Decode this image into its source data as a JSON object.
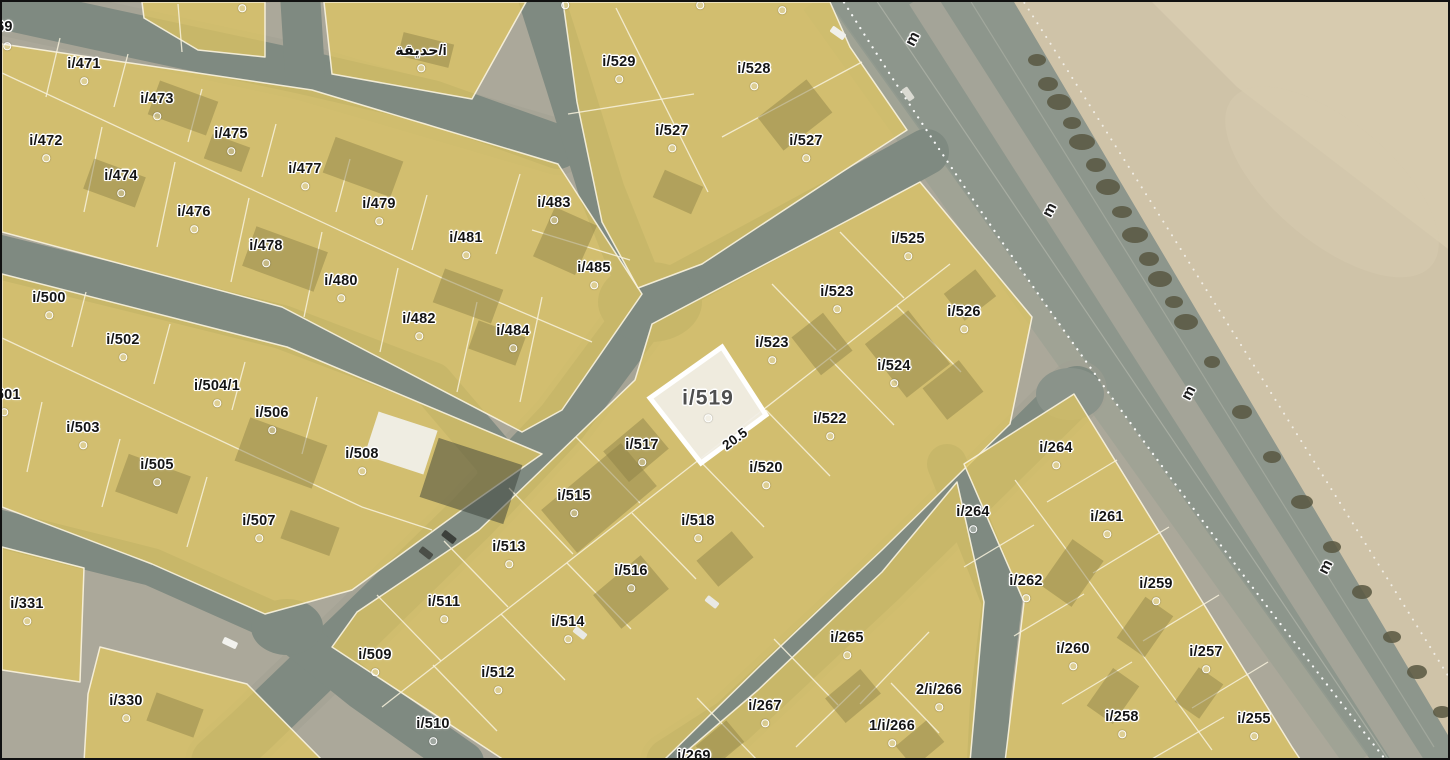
{
  "map": {
    "type": "cadastral-satellite-map",
    "selected_parcel": {
      "label": "i/519",
      "edge_dimension": "20.5"
    },
    "garden_label": "حديقة/i",
    "road_letter": "m",
    "colors": {
      "ground": "#aba89a",
      "parcel": "#dcc463",
      "parcel-line": "#f8f2dd",
      "selected-fill": "#f1eee6",
      "selected-border": "#ffffff",
      "selected-label": "#4f4f4f",
      "road": "#7f8a81",
      "arterial": "#8d968c",
      "sand": "#cfc3a8",
      "vegetation": "#585741",
      "label": "#141414"
    },
    "labels": [
      {
        "t": "i/469",
        "x": -6,
        "y": 25,
        "dot": false
      },
      {
        "t": "i/471",
        "x": 82,
        "y": 62
      },
      {
        "t": "i/473",
        "x": 155,
        "y": 97
      },
      {
        "t": "i/475",
        "x": 229,
        "y": 132
      },
      {
        "t": "i/477",
        "x": 303,
        "y": 167
      },
      {
        "t": "i/479",
        "x": 377,
        "y": 202
      },
      {
        "t": "i/481",
        "x": 464,
        "y": 236
      },
      {
        "t": "i/483",
        "x": 552,
        "y": 201
      },
      {
        "t": "i/485",
        "x": 592,
        "y": 266
      },
      {
        "t": "i/472",
        "x": 44,
        "y": 139
      },
      {
        "t": "i/474",
        "x": 119,
        "y": 174
      },
      {
        "t": "i/476",
        "x": 192,
        "y": 210
      },
      {
        "t": "i/478",
        "x": 264,
        "y": 244
      },
      {
        "t": "i/480",
        "x": 339,
        "y": 279
      },
      {
        "t": "i/482",
        "x": 417,
        "y": 317
      },
      {
        "t": "i/484",
        "x": 511,
        "y": 329
      },
      {
        "t": "حديقة/i",
        "x": 419,
        "y": 49
      },
      {
        "t": "i/529",
        "x": 617,
        "y": 60
      },
      {
        "t": "i/527",
        "x": 670,
        "y": 129
      },
      {
        "t": "i/528",
        "x": 752,
        "y": 67
      },
      {
        "t": "i/527",
        "x": 804,
        "y": 139
      },
      {
        "t": "i/500",
        "x": 47,
        "y": 296
      },
      {
        "t": "i/502",
        "x": 121,
        "y": 338
      },
      {
        "t": "i/504/1",
        "x": 215,
        "y": 384
      },
      {
        "t": "i/506",
        "x": 270,
        "y": 411
      },
      {
        "t": "i/508",
        "x": 360,
        "y": 452
      },
      {
        "t": "i/501",
        "x": 2,
        "y": 393
      },
      {
        "t": "i/503",
        "x": 81,
        "y": 426
      },
      {
        "t": "i/505",
        "x": 155,
        "y": 463
      },
      {
        "t": "i/507",
        "x": 257,
        "y": 519
      },
      {
        "t": "i/331",
        "x": 25,
        "y": 602
      },
      {
        "t": "i/330",
        "x": 124,
        "y": 699
      },
      {
        "t": "i/509",
        "x": 373,
        "y": 653
      },
      {
        "t": "i/511",
        "x": 442,
        "y": 600
      },
      {
        "t": "i/513",
        "x": 507,
        "y": 545
      },
      {
        "t": "i/515",
        "x": 572,
        "y": 494
      },
      {
        "t": "i/517",
        "x": 640,
        "y": 443
      },
      {
        "t": "i/519",
        "x": 706,
        "y": 396,
        "k": "big"
      },
      {
        "t": "20.5",
        "x": 733,
        "y": 437,
        "k": "dim",
        "dot": false
      },
      {
        "t": "i/510",
        "x": 431,
        "y": 722
      },
      {
        "t": "i/512",
        "x": 496,
        "y": 671
      },
      {
        "t": "i/514",
        "x": 566,
        "y": 620
      },
      {
        "t": "i/516",
        "x": 629,
        "y": 569
      },
      {
        "t": "i/518",
        "x": 696,
        "y": 519
      },
      {
        "t": "i/520",
        "x": 764,
        "y": 466
      },
      {
        "t": "i/522",
        "x": 828,
        "y": 417
      },
      {
        "t": "i/523",
        "x": 770,
        "y": 341
      },
      {
        "t": "i/523",
        "x": 835,
        "y": 290
      },
      {
        "t": "i/525",
        "x": 906,
        "y": 237
      },
      {
        "t": "i/526",
        "x": 962,
        "y": 310
      },
      {
        "t": "i/524",
        "x": 892,
        "y": 364
      },
      {
        "t": "i/265",
        "x": 845,
        "y": 636
      },
      {
        "t": "i/267",
        "x": 763,
        "y": 704
      },
      {
        "t": "i/269",
        "x": 692,
        "y": 754,
        "dot": false
      },
      {
        "t": "1/i/266",
        "x": 890,
        "y": 724
      },
      {
        "t": "2/i/266",
        "x": 937,
        "y": 688
      },
      {
        "t": "i/264",
        "x": 1054,
        "y": 446
      },
      {
        "t": "i/264",
        "x": 971,
        "y": 510
      },
      {
        "t": "i/261",
        "x": 1105,
        "y": 515
      },
      {
        "t": "i/262",
        "x": 1024,
        "y": 579
      },
      {
        "t": "i/259",
        "x": 1154,
        "y": 582
      },
      {
        "t": "i/260",
        "x": 1071,
        "y": 647
      },
      {
        "t": "i/257",
        "x": 1204,
        "y": 650
      },
      {
        "t": "i/258",
        "x": 1120,
        "y": 715
      },
      {
        "t": "i/255",
        "x": 1252,
        "y": 717
      },
      {
        "t": "m",
        "x": 911,
        "y": 37,
        "k": "road",
        "dot": false
      },
      {
        "t": "m",
        "x": 1048,
        "y": 208,
        "k": "road",
        "dot": false
      },
      {
        "t": "m",
        "x": 1187,
        "y": 391,
        "k": "road",
        "dot": false
      },
      {
        "t": "m",
        "x": 1324,
        "y": 565,
        "k": "road",
        "dot": false
      }
    ],
    "extra_centroid_dots": [
      [
        5,
        44
      ],
      [
        563,
        3
      ],
      [
        698,
        3
      ],
      [
        240,
        6
      ],
      [
        780,
        8
      ]
    ]
  }
}
